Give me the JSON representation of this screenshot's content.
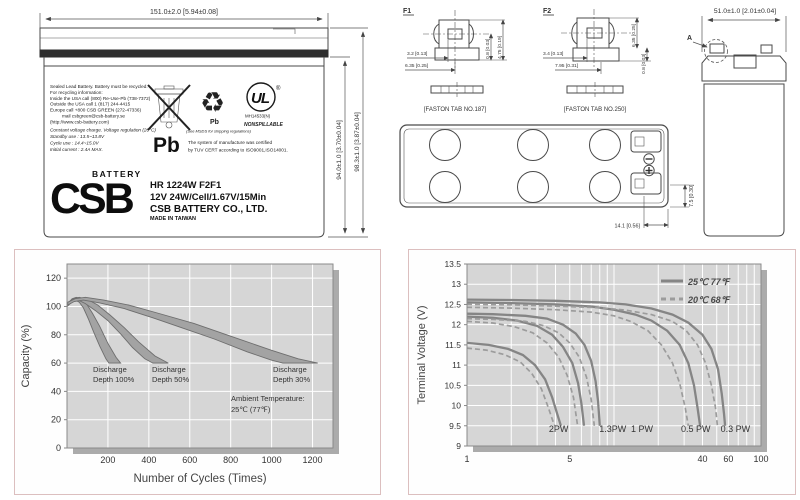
{
  "colors": {
    "accent_border": "#dcbfbf",
    "plot_bg": "#d6d6d6",
    "grid": "#ffffff",
    "shadow": "#ababab",
    "band_fill": "#a3a3a3",
    "band_stroke": "#6e6e6e",
    "curve_solid": "#858585",
    "curve_dashed": "#9c9c9c",
    "ink": "#3c3c3c"
  },
  "front": {
    "dim_width": "151.0±2.0  [5.94±0.08]",
    "dim_h1": "94.0±1.0 [3.70±0.04]",
    "dim_h2": "98.3±1.0 [3.87±0.04]",
    "recycle_lines": [
      "Sealed Lead Battery. Battery must be recycled.",
      "For recycling information:",
      "Inside    the USA call (800) Re-Use-Pb (738-7372)",
      "Outside the USA call 1 (817) 244-4415",
      "Europe call   +800 CSB GREEN (272-47336)",
      "mail   csbgreen@csb-battery.se",
      "(http://www.csb-battery.com)"
    ],
    "charge_lines": [
      "Constant voltage charge. Voltage regulation (20°C)",
      "Standby use  : 13.5~13.8V",
      "Cycle use     : 14.4~15.0V",
      "Initial current : 2.4A MAX."
    ],
    "pb_large": "Pb",
    "recycle_pb": "Pb",
    "msds_note": "(See MSDS for shipping regulations)",
    "ul_text": "UL",
    "ul_code": "MH14533(N)",
    "nonspillable": "NONSPILLABLE",
    "tuv_line1": "The system of manufacture was certified",
    "tuv_line2": "by TUV CERT according to ISO9001,ISO14001.",
    "brand": "CSB",
    "brand_sub": "BATTERY",
    "model": "HR 1224W F2F1",
    "spec": "12V 24W/Cell/1.67V/15Min",
    "company": "CSB BATTERY CO., LTD.",
    "origin": "MADE IN TAIWAN"
  },
  "terminals": {
    "f1": {
      "title": "F1",
      "dim1": "3.2 [0.13]",
      "dim2": "6.35 [0.25]",
      "dim3": "0.8 [0.03]",
      "dim4": "4.75 [0.19]",
      "caption": "[FASTON TAB NO.187]"
    },
    "f2": {
      "title": "F2",
      "dim1": "3.4 [0.13]",
      "dim2": "7.95 [0.31]",
      "dim3": "0.8 [0.03]",
      "dim4": "6.35 [0.25]",
      "caption": "[FASTON TAB NO.250]"
    }
  },
  "top_view": {
    "dim_w": "14.1  [0.56]",
    "dim_h": "7.5  [0.30]"
  },
  "side_view": {
    "dim_width": "51.0±1.0  [2.01±0.04]",
    "detail": "A"
  },
  "chart_data": [
    {
      "type": "area",
      "title": "",
      "xlabel": "Number of Cycles (Times)",
      "ylabel": "Capacity (%)",
      "xlim": [
        0,
        1300
      ],
      "ylim": [
        0,
        130
      ],
      "xticks": [
        200,
        400,
        600,
        800,
        1000,
        1200
      ],
      "yticks": [
        0,
        20,
        40,
        60,
        80,
        100,
        120
      ],
      "grid": true,
      "annotations": {
        "d100": [
          "Discharge",
          "Depth 100%"
        ],
        "d50": [
          "Discharge",
          "Depth 50%"
        ],
        "d30": [
          "Discharge",
          "Depth 30%"
        ],
        "ambient": [
          "Ambient Temperature:",
          "25℃  (77℉)"
        ]
      },
      "bands": [
        {
          "label": "Discharge Depth 100%",
          "upper": [
            [
              4,
              102
            ],
            [
              25,
              105.5
            ],
            [
              45,
              106.5
            ],
            [
              70,
              105.5
            ],
            [
              95,
              102
            ],
            [
              125,
              95
            ],
            [
              160,
              86
            ],
            [
              200,
              74
            ],
            [
              240,
              64
            ],
            [
              262,
              60
            ]
          ],
          "lower": [
            [
              4,
              100.5
            ],
            [
              22,
              103.5
            ],
            [
              40,
              104.5
            ],
            [
              60,
              103
            ],
            [
              80,
              99
            ],
            [
              105,
              91
            ],
            [
              130,
              82
            ],
            [
              160,
              72
            ],
            [
              190,
              63
            ],
            [
              205,
              60
            ]
          ]
        },
        {
          "label": "Discharge Depth 50%",
          "upper": [
            [
              4,
              102.5
            ],
            [
              30,
              105.5
            ],
            [
              60,
              106.5
            ],
            [
              100,
              105
            ],
            [
              150,
              101
            ],
            [
              210,
              94
            ],
            [
              280,
              85
            ],
            [
              350,
              75
            ],
            [
              430,
              65
            ],
            [
              495,
              60
            ]
          ],
          "lower": [
            [
              4,
              100.5
            ],
            [
              28,
              103.5
            ],
            [
              55,
              104.5
            ],
            [
              90,
              102
            ],
            [
              140,
              97
            ],
            [
              200,
              90
            ],
            [
              260,
              81
            ],
            [
              320,
              71
            ],
            [
              380,
              63
            ],
            [
              420,
              60
            ]
          ]
        },
        {
          "label": "Discharge Depth 30%",
          "upper": [
            [
              4,
              103
            ],
            [
              40,
              105.5
            ],
            [
              90,
              106.5
            ],
            [
              180,
              104.5
            ],
            [
              300,
              101
            ],
            [
              450,
              95
            ],
            [
              620,
              88
            ],
            [
              800,
              79
            ],
            [
              1000,
              69
            ],
            [
              1130,
              63
            ],
            [
              1225,
              60
            ]
          ],
          "lower": [
            [
              4,
              101
            ],
            [
              35,
              103.5
            ],
            [
              80,
              104.5
            ],
            [
              160,
              102.5
            ],
            [
              280,
              98.5
            ],
            [
              420,
              92
            ],
            [
              560,
              85
            ],
            [
              720,
              77
            ],
            [
              880,
              68
            ],
            [
              1000,
              62
            ],
            [
              1055,
              60
            ]
          ]
        }
      ]
    },
    {
      "type": "line",
      "title": "",
      "xlabel": "",
      "ylabel": "Terminal Voltage (V)",
      "x_scale": "log",
      "xlim": [
        1,
        100
      ],
      "ylim": [
        9,
        13.5
      ],
      "xticks": [
        1,
        5,
        40,
        60,
        100
      ],
      "yticks": [
        9,
        9.5,
        10,
        10.5,
        11,
        11.5,
        12,
        12.5,
        13,
        13.5
      ],
      "grid": true,
      "legend": [
        {
          "label": "25℃ 77℉",
          "style": "solid"
        },
        {
          "label": "20℃ 68℉",
          "style": "dashed"
        }
      ],
      "curve_labels": [
        {
          "text": "2PW",
          "x": 4.2
        },
        {
          "text": "1.3PW",
          "x": 9.8
        },
        {
          "text": "1 PW",
          "x": 15.5
        },
        {
          "text": "0.5 PW",
          "x": 36
        },
        {
          "text": "0.3 PW",
          "x": 67
        }
      ],
      "series": [
        {
          "name": "0.3PW 25C",
          "style": "solid",
          "points": [
            [
              1,
              12.62
            ],
            [
              2,
              12.61
            ],
            [
              4,
              12.59
            ],
            [
              8,
              12.55
            ],
            [
              12,
              12.5
            ],
            [
              18,
              12.4
            ],
            [
              25,
              12.25
            ],
            [
              32,
              12.05
            ],
            [
              40,
              11.75
            ],
            [
              46,
              11.4
            ],
            [
              51,
              10.9
            ],
            [
              54,
              10.3
            ],
            [
              56,
              9.8
            ],
            [
              57,
              9.5
            ]
          ]
        },
        {
          "name": "0.5PW 25C",
          "style": "solid",
          "points": [
            [
              1,
              12.55
            ],
            [
              2,
              12.53
            ],
            [
              4,
              12.5
            ],
            [
              7,
              12.45
            ],
            [
              10,
              12.37
            ],
            [
              14,
              12.25
            ],
            [
              18,
              12.1
            ],
            [
              23,
              11.85
            ],
            [
              28,
              11.5
            ],
            [
              32,
              11.05
            ],
            [
              35,
              10.5
            ],
            [
              37,
              9.95
            ],
            [
              38.5,
              9.5
            ]
          ]
        },
        {
          "name": "1PW 25C",
          "style": "solid",
          "points": [
            [
              1,
              12.27
            ],
            [
              1.5,
              12.26
            ],
            [
              2.5,
              12.22
            ],
            [
              3.5,
              12.15
            ],
            [
              4.5,
              12.0
            ],
            [
              5.5,
              11.78
            ],
            [
              6.3,
              11.5
            ],
            [
              7.0,
              11.1
            ],
            [
              7.5,
              10.6
            ],
            [
              7.8,
              10.1
            ],
            [
              8.0,
              9.5
            ]
          ]
        },
        {
          "name": "1.3PW 25C",
          "style": "solid",
          "points": [
            [
              1,
              12.2
            ],
            [
              1.5,
              12.17
            ],
            [
              2.2,
              12.1
            ],
            [
              3.0,
              11.97
            ],
            [
              3.8,
              11.75
            ],
            [
              4.5,
              11.45
            ],
            [
              5.2,
              11.05
            ],
            [
              5.7,
              10.55
            ],
            [
              6.0,
              10.05
            ],
            [
              6.25,
              9.5
            ]
          ]
        },
        {
          "name": "2PW 25C",
          "style": "solid",
          "points": [
            [
              1,
              11.55
            ],
            [
              1.4,
              11.5
            ],
            [
              1.9,
              11.4
            ],
            [
              2.4,
              11.25
            ],
            [
              2.9,
              11.0
            ],
            [
              3.4,
              10.65
            ],
            [
              3.8,
              10.2
            ],
            [
              4.1,
              9.8
            ],
            [
              4.35,
              9.5
            ]
          ]
        },
        {
          "name": "0.3PW 20C",
          "style": "dashed",
          "points": [
            [
              1,
              12.5
            ],
            [
              2,
              12.49
            ],
            [
              4,
              12.46
            ],
            [
              8,
              12.42
            ],
            [
              12,
              12.36
            ],
            [
              18,
              12.25
            ],
            [
              25,
              12.08
            ],
            [
              31,
              11.85
            ],
            [
              37,
              11.5
            ],
            [
              42,
              11.05
            ],
            [
              46,
              10.5
            ],
            [
              49,
              9.95
            ],
            [
              50.5,
              9.5
            ]
          ]
        },
        {
          "name": "0.5PW 20C",
          "style": "dashed",
          "points": [
            [
              1,
              12.43
            ],
            [
              2,
              12.41
            ],
            [
              4,
              12.37
            ],
            [
              7,
              12.31
            ],
            [
              10,
              12.22
            ],
            [
              13,
              12.08
            ],
            [
              17,
              11.85
            ],
            [
              21,
              11.5
            ],
            [
              25,
              11.05
            ],
            [
              28,
              10.55
            ],
            [
              30.5,
              9.95
            ],
            [
              32,
              9.5
            ]
          ]
        },
        {
          "name": "1PW 20C",
          "style": "dashed",
          "points": [
            [
              1,
              12.15
            ],
            [
              1.5,
              12.13
            ],
            [
              2.5,
              12.08
            ],
            [
              3.3,
              11.98
            ],
            [
              4.2,
              11.8
            ],
            [
              5.0,
              11.55
            ],
            [
              5.8,
              11.2
            ],
            [
              6.5,
              10.7
            ],
            [
              7.0,
              10.15
            ],
            [
              7.35,
              9.5
            ]
          ]
        },
        {
          "name": "1.3PW 20C",
          "style": "dashed",
          "points": [
            [
              1,
              12.08
            ],
            [
              1.5,
              12.04
            ],
            [
              2.1,
              11.95
            ],
            [
              2.8,
              11.8
            ],
            [
              3.5,
              11.55
            ],
            [
              4.2,
              11.2
            ],
            [
              4.8,
              10.75
            ],
            [
              5.3,
              10.2
            ],
            [
              5.65,
              9.5
            ]
          ]
        },
        {
          "name": "2PW 20C",
          "style": "dashed",
          "points": [
            [
              1,
              11.42
            ],
            [
              1.35,
              11.37
            ],
            [
              1.8,
              11.26
            ],
            [
              2.3,
              11.08
            ],
            [
              2.75,
              10.8
            ],
            [
              3.2,
              10.42
            ],
            [
              3.55,
              9.98
            ],
            [
              3.85,
              9.6
            ],
            [
              3.95,
              9.5
            ]
          ]
        }
      ]
    }
  ]
}
